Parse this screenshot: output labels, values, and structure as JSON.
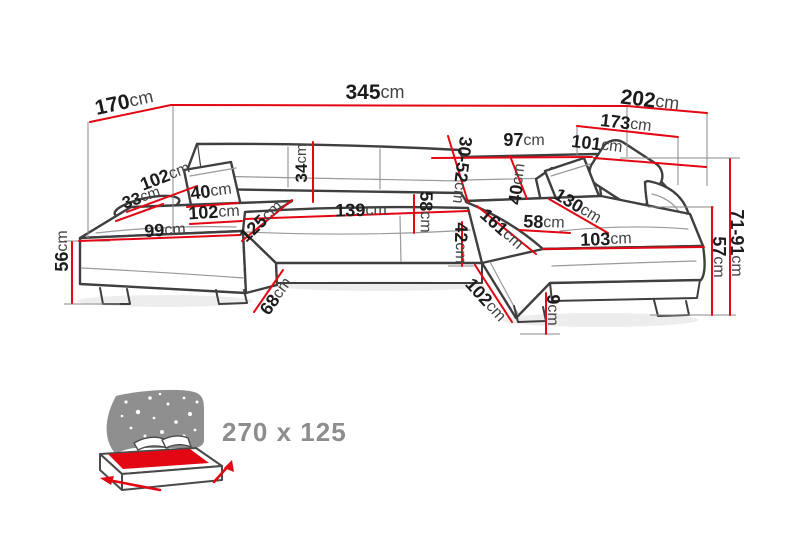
{
  "diagram": {
    "description_unit": "cm",
    "dimensions": [
      {
        "id": "depth-left-top",
        "value": "170",
        "unit": "cm",
        "x": 124,
        "y": 102,
        "rotate": -12,
        "size": 21
      },
      {
        "id": "total-width-back",
        "value": "345",
        "unit": "cm",
        "x": 375,
        "y": 92,
        "rotate": 0,
        "size": 21
      },
      {
        "id": "depth-right-top",
        "value": "202",
        "unit": "cm",
        "x": 650,
        "y": 100,
        "rotate": 7,
        "size": 21
      },
      {
        "id": "right-section-length",
        "value": "173",
        "unit": "cm",
        "x": 626,
        "y": 123,
        "rotate": 7,
        "size": 18
      },
      {
        "id": "back-segment-right",
        "value": "97",
        "unit": "cm",
        "x": 524,
        "y": 140,
        "rotate": 0,
        "size": 18
      },
      {
        "id": "inner-right-length",
        "value": "101",
        "unit": "cm",
        "x": 597,
        "y": 144,
        "rotate": 7,
        "size": 18
      },
      {
        "id": "armrest-diag-left",
        "value": "102",
        "unit": "cm",
        "x": 165,
        "y": 176,
        "rotate": -21,
        "size": 18
      },
      {
        "id": "pillow-roll-left",
        "value": "33",
        "unit": "cm",
        "x": 141,
        "y": 197,
        "rotate": -19,
        "size": 17
      },
      {
        "id": "pillow-left",
        "value": "40",
        "unit": "cm",
        "x": 211,
        "y": 191,
        "rotate": -7,
        "size": 18
      },
      {
        "id": "seat-width-left",
        "value": "102",
        "unit": "cm",
        "x": 214,
        "y": 212,
        "rotate": -3,
        "size": 18
      },
      {
        "id": "seat-front-left",
        "value": "99",
        "unit": "cm",
        "x": 165,
        "y": 230,
        "rotate": -3,
        "size": 18
      },
      {
        "id": "chaise-depth-left",
        "value": "125",
        "unit": "cm",
        "x": 261,
        "y": 221,
        "rotate": -43,
        "size": 18
      },
      {
        "id": "backrest-height",
        "value": "34",
        "unit": "cm",
        "x": 301,
        "y": 163,
        "rotate": -90,
        "size": 17
      },
      {
        "id": "seat-width-center",
        "value": "139",
        "unit": "cm",
        "x": 361,
        "y": 210,
        "rotate": -1,
        "size": 18
      },
      {
        "id": "seat-depth-center",
        "value": "58",
        "unit": "cm",
        "x": 426,
        "y": 212,
        "rotate": 91,
        "size": 18
      },
      {
        "id": "headrest-range",
        "value": "30-52",
        "unit": "cm",
        "x": 462,
        "y": 170,
        "rotate": 97,
        "size": 18
      },
      {
        "id": "pillow-right",
        "value": "40",
        "unit": "cm",
        "x": 517,
        "y": 184,
        "rotate": -83,
        "size": 18
      },
      {
        "id": "chaise-inner-right",
        "value": "161",
        "unit": "cm",
        "x": 502,
        "y": 229,
        "rotate": 42,
        "size": 18
      },
      {
        "id": "seat-depth-right",
        "value": "58",
        "unit": "cm",
        "x": 544,
        "y": 222,
        "rotate": 2,
        "size": 18
      },
      {
        "id": "backrest-diag-right",
        "value": "130",
        "unit": "cm",
        "x": 578,
        "y": 206,
        "rotate": 31,
        "size": 18
      },
      {
        "id": "seat-width-right",
        "value": "103",
        "unit": "cm",
        "x": 606,
        "y": 239,
        "rotate": -2,
        "size": 18
      },
      {
        "id": "seat-front-height",
        "value": "42",
        "unit": "cm",
        "x": 461,
        "y": 243,
        "rotate": 91,
        "size": 18
      },
      {
        "id": "side-height-left",
        "value": "56",
        "unit": "cm",
        "x": 62,
        "y": 251,
        "rotate": -90,
        "size": 18
      },
      {
        "id": "corner-edge-left",
        "value": "68",
        "unit": "cm",
        "x": 276,
        "y": 296,
        "rotate": -54,
        "size": 18
      },
      {
        "id": "corner-edge-right",
        "value": "102",
        "unit": "cm",
        "x": 486,
        "y": 300,
        "rotate": 48,
        "size": 18
      },
      {
        "id": "leg-height",
        "value": "9",
        "unit": "cm",
        "x": 553,
        "y": 310,
        "rotate": 90,
        "size": 18
      },
      {
        "id": "seat-height-right",
        "value": "57",
        "unit": "cm",
        "x": 719,
        "y": 257,
        "rotate": 90,
        "size": 18
      },
      {
        "id": "back-height-range",
        "value": "71-91",
        "unit": "cm",
        "x": 737,
        "y": 243,
        "rotate": 90,
        "size": 18
      }
    ]
  },
  "sleeping": {
    "label": "270 x 125"
  },
  "colors": {
    "dimension_line": "#e30613",
    "sofa_outline": "#3f3f3f",
    "label_number": "#1c1c1c",
    "label_unit": "#434343",
    "extension_line": "#8a8a8a",
    "bed_icon_gray": "#8f8f8f",
    "sleeping_text": "#8d8d8d"
  }
}
